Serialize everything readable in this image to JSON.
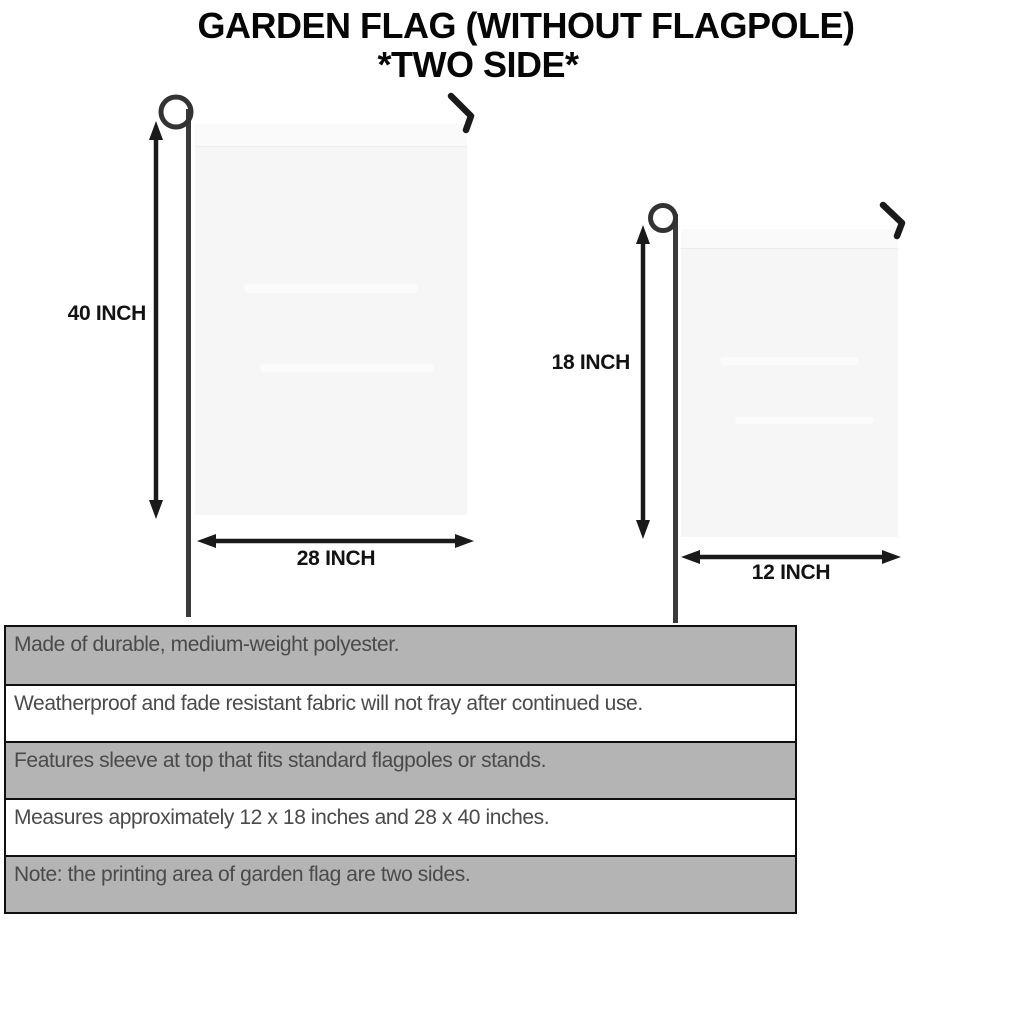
{
  "title": {
    "line1": "GARDEN FLAG (WITHOUT FLAGPOLE)",
    "line2": "*TWO SIDE*"
  },
  "flags": [
    {
      "size": "large",
      "height_label": "40 INCH",
      "width_label": "28 INCH"
    },
    {
      "size": "small",
      "height_label": "18 INCH",
      "width_label": "12 INCH"
    }
  ],
  "features": [
    "Made of durable, medium-weight polyester.",
    "Weatherproof and fade resistant fabric will not fray after continued use.",
    "Features sleeve at top that fits standard flagpoles or stands.",
    "Measures approximately 12 x 18 inches and 28 x 40 inches.",
    "Note: the printing area of garden flag are two sides."
  ],
  "colors": {
    "row_gray": "#b4b4b4",
    "row_white": "#ffffff",
    "table_border": "#101010",
    "table_text": "#4a4a4a",
    "flag_fill": "#f6f6f6",
    "ink": "#1a1a1a"
  }
}
